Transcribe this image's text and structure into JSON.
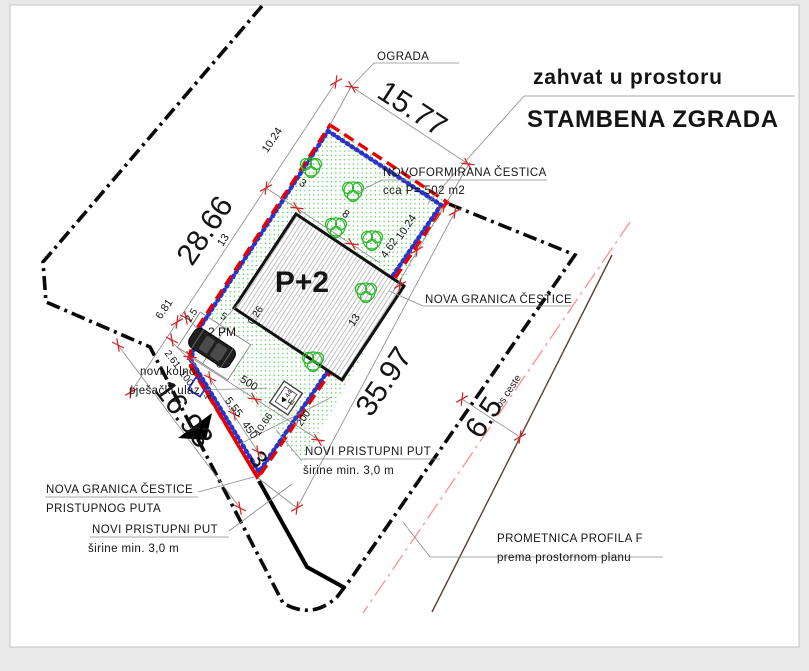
{
  "title": {
    "subtitle": "zahvat u prostoru",
    "main": "STAMBENA ZGRADA"
  },
  "labels": {
    "ograda": "OGRADA",
    "novoformirana_cestica": "NOVOFORMIRANA ČESTICA",
    "novoformirana_area": "cca P= 502 m2",
    "nova_granica_cestice": "NOVA GRANICA ČESTICE",
    "kolni_ulaz_1": "novi kolno-",
    "kolni_ulaz_2": "pješački ulaz",
    "granica_puta_1": "NOVA GRANICA ČESTICE",
    "granica_puta_2": "PRISTUPNOG PUTA",
    "pristupni_put_1": "NOVI PRISTUPNI PUT",
    "pristupni_put_2": "širine min. 3,0 m",
    "pristupni_put_donji_1": "NOVI PRISTUPNI PUT",
    "pristupni_put_donji_2": "širine min. 3,0 m",
    "prometnica_1": "PROMETNICA PROFILA F",
    "prometnica_2": "prema prostornom planu",
    "os_ceste": "os ceste",
    "building": "P+2",
    "parking": "2 PM",
    "vodomjer": "vo",
    "ebox_letter": "E",
    "ebox_value": "44"
  },
  "dimensions": {
    "granica_total": "28.66",
    "ograda_len": "15.77",
    "se_total": "35.97",
    "put_len": "16.93",
    "road_width": "6.5",
    "put_width": "3",
    "nw_1": "10.24",
    "nw_2": "13",
    "nw_3": "6.81",
    "top_offset": "3",
    "top_len": "8",
    "se_1": "10.24",
    "se_2": "4.62",
    "se_3": "13",
    "mid_len": "8",
    "mid_500": "500",
    "path_555": "5.55",
    "path_450": "450",
    "path_100": "100",
    "edge_261": "2.61",
    "edge_25": "2.5",
    "bldg_offset": "0.26",
    "bldg_5": "5",
    "box_1066": "10.66",
    "box_200": "200"
  },
  "colors": {
    "new_boundary_red": "#e60000",
    "hatch_blue": "#2a35c8",
    "tree_green": "#2db82d",
    "dots_green": "#3ec43e",
    "existing_boundary_black": "#0a0a0a",
    "road_axis_pink": "#ff8f8f",
    "tick_red": "#d42020",
    "paper": "#ffffff",
    "frame": "#e9e9e9"
  }
}
